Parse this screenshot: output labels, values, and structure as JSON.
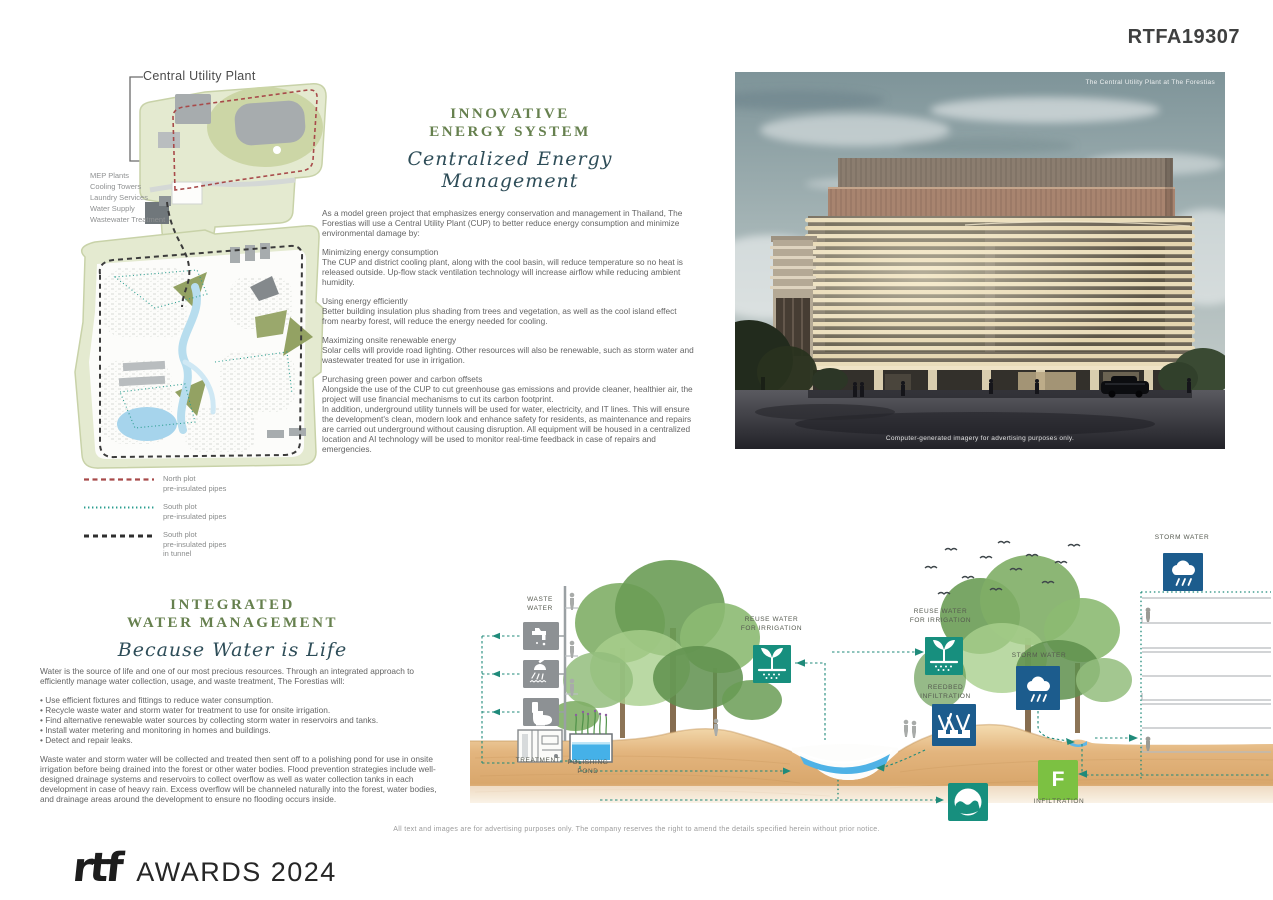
{
  "board": {
    "id": "RTFA19307"
  },
  "site_plan": {
    "title": "Central Utility Plant",
    "facilities": [
      "MEP Plants",
      "Cooling Towers",
      "Laundry Services",
      "Water Supply",
      "Wastewater Treatment"
    ],
    "legend": [
      {
        "label": "North plot\npre-insulated pipes"
      },
      {
        "label": "South plot\npre-insulated pipes"
      },
      {
        "label": "South plot\npre-insulated pipes\nin tunnel"
      }
    ]
  },
  "energy": {
    "title_line1": "INNOVATIVE",
    "title_line2": "ENERGY SYSTEM",
    "subtitle": "Centralized Energy Management",
    "intro": "As a model green project that emphasizes energy conservation and management in Thailand, The Forestias will use a Central Utility Plant (CUP) to better reduce energy consumption and minimize environmental damage by:",
    "sections": [
      {
        "heading": "Minimizing energy consumption",
        "body": "The CUP and district cooling plant, along with the cool basin, will reduce temperature so no heat is released outside. Up-flow stack ventilation technology will increase airflow while reducing ambient humidity."
      },
      {
        "heading": "Using energy efficiently",
        "body": "Better building insulation plus shading from trees and vegetation, as well as the cool island effect from nearby forest, will reduce the energy needed for cooling."
      },
      {
        "heading": "Maximizing onsite renewable energy",
        "body": "Solar cells will provide road lighting. Other resources will also be renewable, such as storm water and wastewater treated for use in irrigation."
      },
      {
        "heading": "Purchasing green power and carbon offsets",
        "body": "Alongside the use of the CUP to cut greenhouse gas emissions and provide cleaner, healthier air, the project will use financial mechanisms to cut its carbon footprint.\nIn addition, underground utility tunnels will be used for water, electricity, and IT lines. This will ensure the development's clean, modern look and enhance safety for residents, as maintenance and repairs are carried out underground without causing disruption. All equipment will be housed in a centralized location and AI technology will be used to monitor real-time feedback in case of repairs and emergencies."
      }
    ]
  },
  "render": {
    "caption_top": "The Central Utility Plant at The Forestias",
    "caption_bottom": "Computer-generated imagery for advertising purposes only."
  },
  "water": {
    "title_line1": "INTEGRATED",
    "title_line2": "WATER MANAGEMENT",
    "subtitle": "Because Water is Life",
    "intro": "Water is the source of life and one of our most precious resources. Through an integrated approach to efficiently manage water collection, usage, and waste treatment, The Forestias will:",
    "bullets": [
      "•  Use efficient fixtures and fittings to reduce water consumption.",
      "•  Recycle waste water and storm water for treatment to use for onsite irrigation.",
      "•  Find alternative renewable water sources by collecting storm water in reservoirs and tanks.",
      "•  Install water metering and monitoring in homes and buildings.",
      "•  Detect and repair leaks."
    ],
    "outro": "Waste water and storm water will be collected and treated then sent off to a polishing pond for use in onsite irrigation before being drained into the forest or other water bodies. Flood prevention strategies include well-designed drainage systems and reservoirs to collect overflow as well as water collection tanks in each development in case of heavy rain. Excess overflow will be channeled naturally into the forest, water bodies, and drainage areas around the development to ensure no flooding occurs inside."
  },
  "diagram": {
    "waste_water": "WASTE\nWATER",
    "treatment": "TREATMENT",
    "polishing_pond": "POLISHING\nPOND",
    "reuse_1": "REUSE WATER\nFOR IRRIGATION",
    "reuse_2": "REUSE WATER\nFOR IRRIGATION",
    "reedbed": "REEDBED\nINFILTRATION",
    "storm_mid": "STORM WATER",
    "storm_top": "STORM WATER",
    "infiltration": "INFILTRATION",
    "f_label": "F"
  },
  "footer": {
    "disclaimer": "All text and images are for advertising purposes only. The company reserves the right to amend the details specified herein without prior notice.",
    "logo": "rtf",
    "awards": "AWARDS 2024"
  },
  "colors": {
    "heading_green": "#66804e",
    "script_teal": "#2e4d58",
    "accent_teal": "#178f7e",
    "accent_blue": "#1c5c8d",
    "infiltration_green": "#7cc142",
    "legend_red": "#a84a4a",
    "legend_teal": "#2a9d8f",
    "sand": "#e0b27a"
  }
}
